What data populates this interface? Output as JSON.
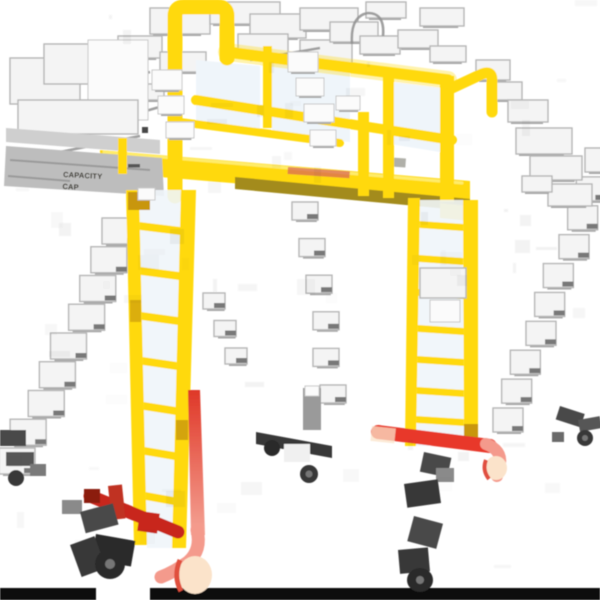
{
  "image": {
    "alt": "Yellow mobile work-platform ladder with safety guardrails, two vertical access ladders, red rolling base frame and black swivel casters, photographed on a white background with heavy compression artifacts",
    "background": "#ffffff"
  },
  "label": {
    "line1": "CAPACITY",
    "line2": "CAP"
  },
  "colors": {
    "bg": "#ffffff",
    "yellow": "#FFD90A",
    "yellow_bright": "#FFEC6B",
    "amber": "#C8960C",
    "olive": "#A38B1A",
    "red": "#E8392A",
    "red_light": "#F49A8C",
    "red_dark": "#C8271B",
    "peach": "#FBE3CA",
    "gray_band": "#BDBDBD",
    "panel_tint": "#EFF5FA",
    "ink": "#2E2C20",
    "black": "#0B0B0B"
  }
}
